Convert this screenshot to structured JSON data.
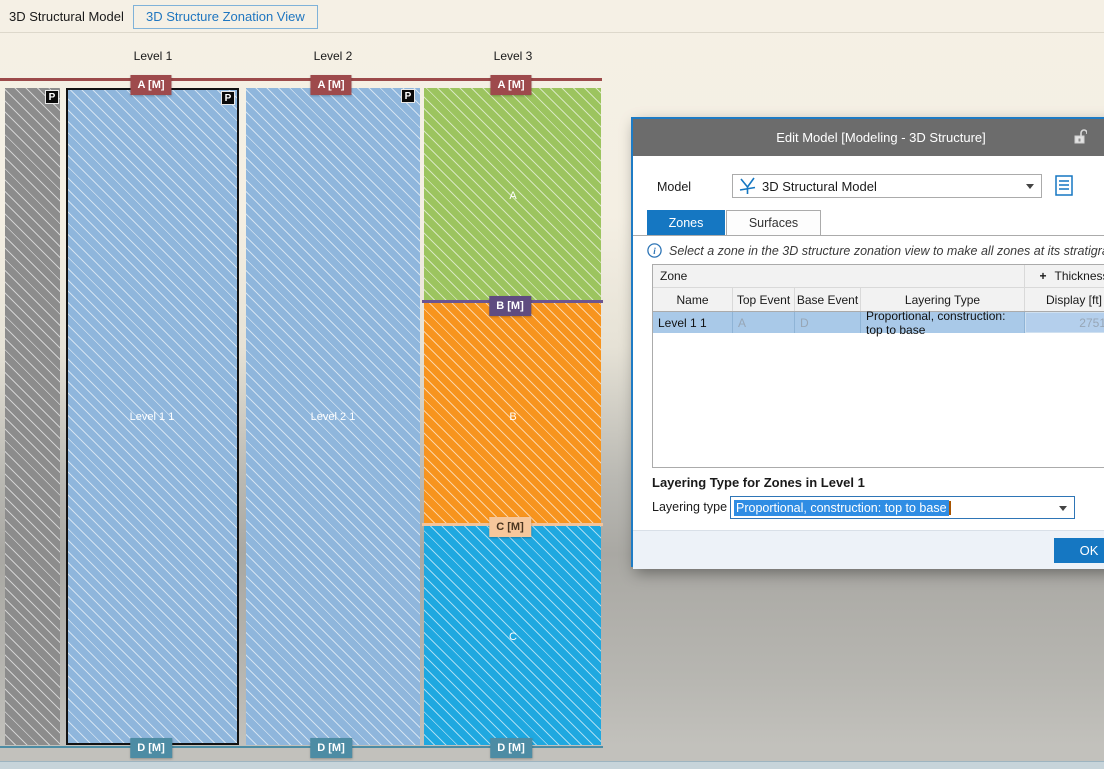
{
  "toolbar": {
    "model_title": "3D Structural Model",
    "view_tab": "3D Structure Zonation View"
  },
  "zonation": {
    "levels": [
      "Level 1",
      "Level 2",
      "Level 3"
    ],
    "badge_a": "A [M]",
    "badge_b": "B [M]",
    "badge_c": "C [M]",
    "badge_d": "D [M]",
    "pillar_badge": "P",
    "zone_level1": "Level 1 1",
    "zone_level2": "Level 2 1",
    "zone_a": "A",
    "zone_b": "B",
    "zone_c": "C"
  },
  "dialog": {
    "title": "Edit Model [Modeling - 3D Structure]",
    "model_label": "Model",
    "model_value": "3D Structural Model",
    "tabs": [
      {
        "label": "Zones"
      },
      {
        "label": "Surfaces"
      }
    ],
    "info_text": "Select a zone in the 3D structure zonation view to make all zones at its stratigraphic level eq",
    "table": {
      "group_zone": "Zone",
      "thickness_expand": "+",
      "group_thickness": "Thickness",
      "columns": [
        "Name",
        "Top Event",
        "Base Event",
        "Layering Type",
        "Display [ft]"
      ],
      "rows": [
        {
          "name": "Level 1 1",
          "top_event": "A",
          "base_event": "D",
          "layering_type": "Proportional, construction: top to base",
          "display": "2751.1"
        }
      ]
    },
    "section_heading": "Layering Type for Zones in Level 1",
    "layering_label": "Layering type",
    "layering_value": "Proportional, construction: top to base",
    "ok_label": "OK"
  },
  "colors": {
    "accent_blue": "#1577c2",
    "selection_row": "#a9c9e8",
    "horizon_a": "#9e4a4c",
    "horizon_b": "#5f4c80",
    "horizon_c": "#f6c79b",
    "horizon_d": "#4d8ca4",
    "zone_blue": "#8fb6dc",
    "zone_green": "#9cc45f",
    "zone_orange": "#f7941e",
    "zone_cyan": "#1fa8e0",
    "pillar_gray": "#8c8c8c"
  }
}
